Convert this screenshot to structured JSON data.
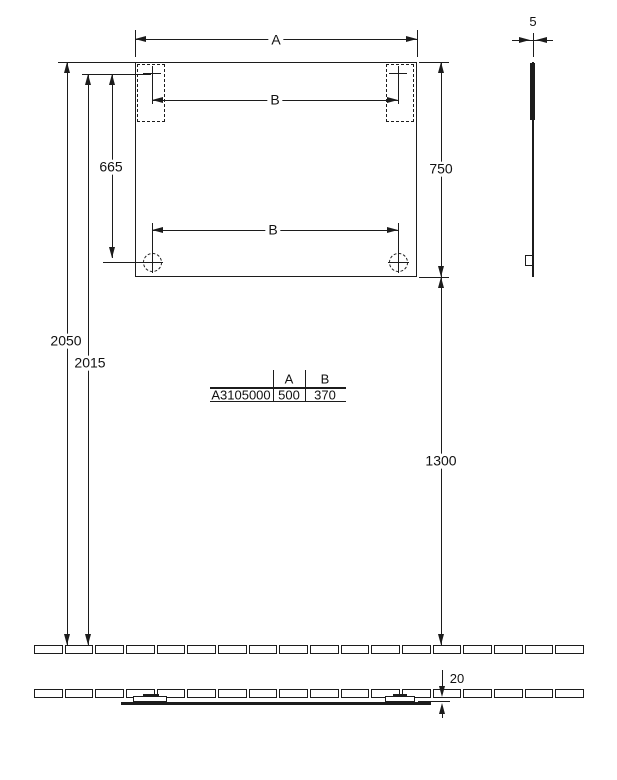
{
  "drawing": {
    "type": "technical-installation-drawing",
    "colors": {
      "line": "#1c1c1c",
      "background": "#ffffff"
    },
    "dims": {
      "a": "A",
      "b": "B",
      "d665": "665",
      "d750": "750",
      "d2050": "2050",
      "d2015": "2015",
      "d1300": "1300",
      "d5": "5",
      "d20": "20"
    },
    "table": {
      "headers": [
        "A",
        "B"
      ],
      "row_label": "A3105000",
      "values": [
        "500",
        "370"
      ]
    },
    "floor": {
      "segment_count": 18
    }
  }
}
